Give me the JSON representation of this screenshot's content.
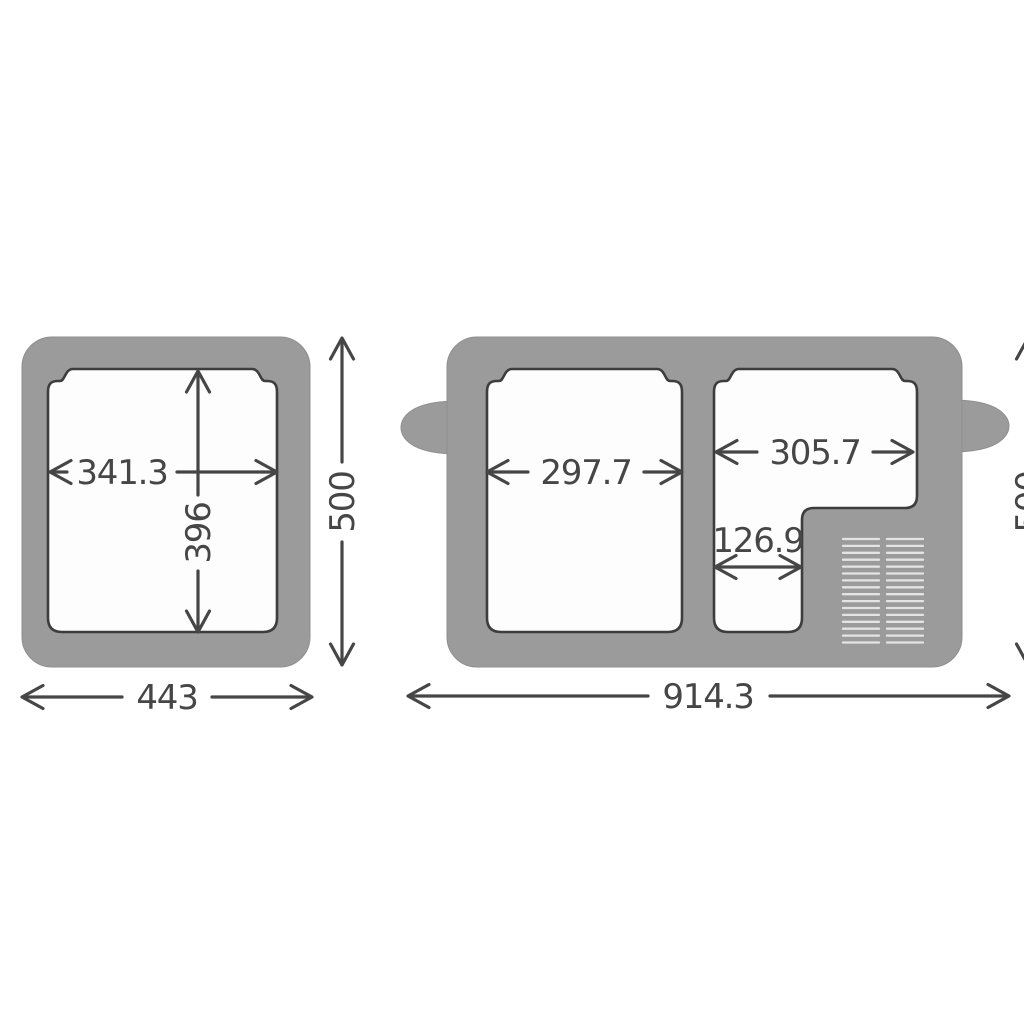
{
  "diagram_title": "cooler-dimension-diagram",
  "colors": {
    "background": "#ffffff",
    "body": "#9b9b9b",
    "body_edge": "#8f8f8f",
    "opening_fill": "#fdfdfd",
    "opening_outline": "#3d3d3d",
    "dimension": "#464646",
    "vent_line": "#e4e4e4"
  },
  "left_view": {
    "name": "single-zone-top-view",
    "dimensions": {
      "inner_width": "341.3",
      "inner_depth": "396",
      "outer_depth": "500",
      "outer_width": "443"
    }
  },
  "right_view": {
    "name": "dual-zone-top-view",
    "dimensions": {
      "left_compartment_width": "297.7",
      "right_compartment_width": "305.7",
      "right_compartment_lower_width": "126.9",
      "outer_width": "914.3",
      "outer_depth": "500"
    },
    "vent_grille": {
      "columns": 2,
      "lines_per_column": 16
    }
  }
}
